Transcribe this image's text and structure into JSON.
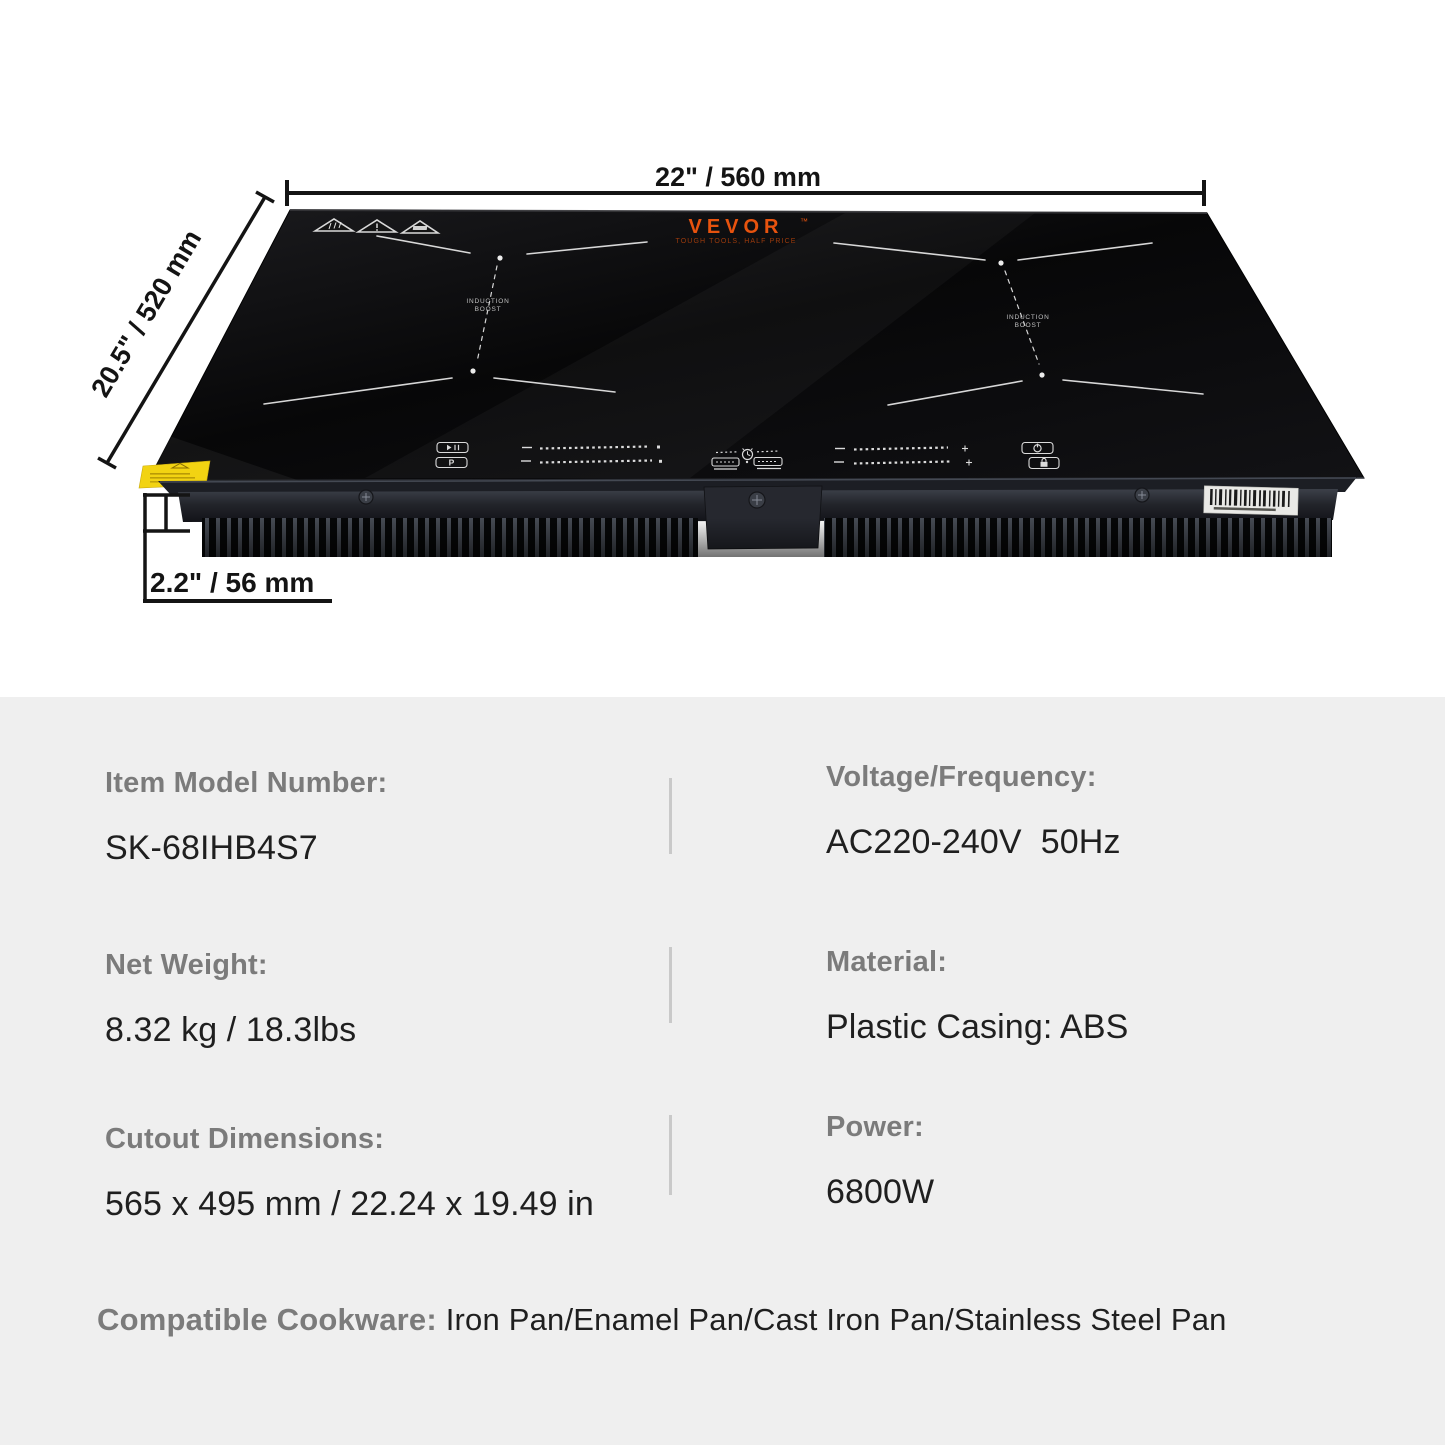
{
  "product": {
    "brand": "VEVOR",
    "brand_tm": "™",
    "brand_slogan": "TOUGH TOOLS, HALF PRICE",
    "zone_label_line1": "INDUCTION",
    "zone_label_line2": "BOOST"
  },
  "dimensions": {
    "width": "22\" / 560 mm",
    "depth": "20.5\" / 520 mm",
    "height": "2.2\" / 56 mm"
  },
  "controls": {
    "boost_label": "P"
  },
  "specs": {
    "left": [
      {
        "label": "Item Model Number:",
        "value": "SK-68IHB4S7"
      },
      {
        "label": "Net Weight:",
        "value": "8.32 kg / 18.3lbs"
      },
      {
        "label": "Cutout Dimensions:",
        "value": "565 x 495 mm / 22.24 x 19.49 in"
      }
    ],
    "right": [
      {
        "label": "Voltage/Frequency:",
        "value": "AC220-240V  50Hz"
      },
      {
        "label": "Material:",
        "value": "Plastic Casing: ABS"
      },
      {
        "label": "Power:",
        "value": "6800W"
      }
    ],
    "footer_label": "Compatible Cookware:",
    "footer_value": " Iron Pan/Enamel Pan/Cast Iron Pan/Stainless Steel Pan"
  },
  "colors": {
    "spec_background": "#efefef",
    "label_gray": "#7b7b7b",
    "value_black": "#1f1f1f",
    "dimension_line": "#141414",
    "brand_orange": "#e8530e",
    "glass_black": "#0a0a0b",
    "sticker_yellow": "#f2d312"
  }
}
